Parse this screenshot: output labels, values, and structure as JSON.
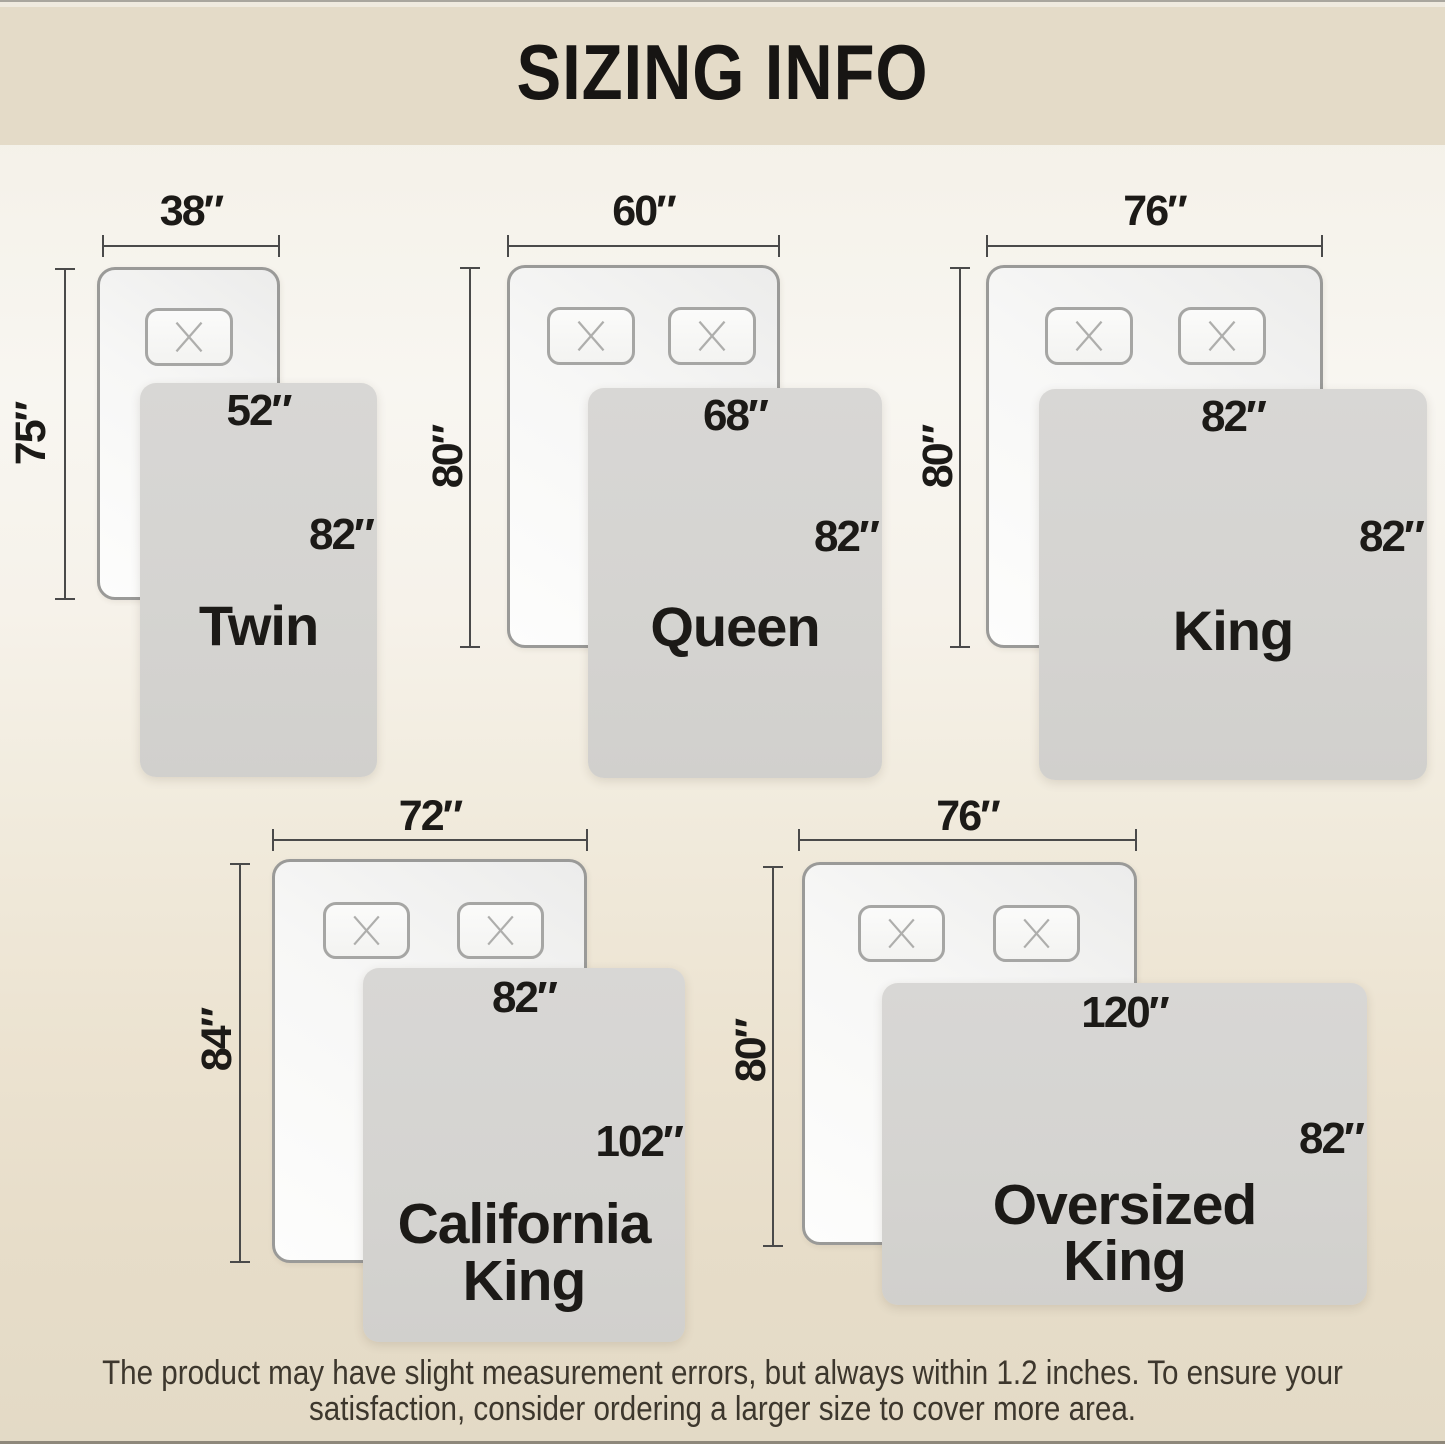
{
  "title": "SIZING INFO",
  "sizes": [
    {
      "name": "Twin",
      "bed_width": "38″",
      "bed_length": "75″",
      "blanket_width": "52″",
      "blanket_length": "82″"
    },
    {
      "name": "Queen",
      "bed_width": "60″",
      "bed_length": "80″",
      "blanket_width": "68″",
      "blanket_length": "82″"
    },
    {
      "name": "King",
      "bed_width": "76″",
      "bed_length": "80″",
      "blanket_width": "82″",
      "blanket_length": "82″"
    },
    {
      "name": "California King",
      "name_line1": "California",
      "name_line2": "King",
      "bed_width": "72″",
      "bed_length": "84″",
      "blanket_width": "82″",
      "blanket_length": "102″"
    },
    {
      "name": "Oversized King",
      "name_line1": "Oversized",
      "name_line2": "King",
      "bed_width": "76″",
      "bed_length": "80″",
      "blanket_width": "120″",
      "blanket_length": "82″"
    }
  ],
  "footer": {
    "line1": "The product may have slight measurement errors, but always within 1.2 inches. To ensure your",
    "line2": "satisfaction, consider ordering a larger size to cover more area."
  },
  "colors": {
    "banner": "#e4dbc8",
    "background_bottom": "#e3dac6",
    "blanket": "#d5d4d1",
    "bed_fill": "#f7f7f6",
    "bed_border": "#9a9a98",
    "arrow": "#4a4a4a",
    "text": "#1c1a17"
  }
}
